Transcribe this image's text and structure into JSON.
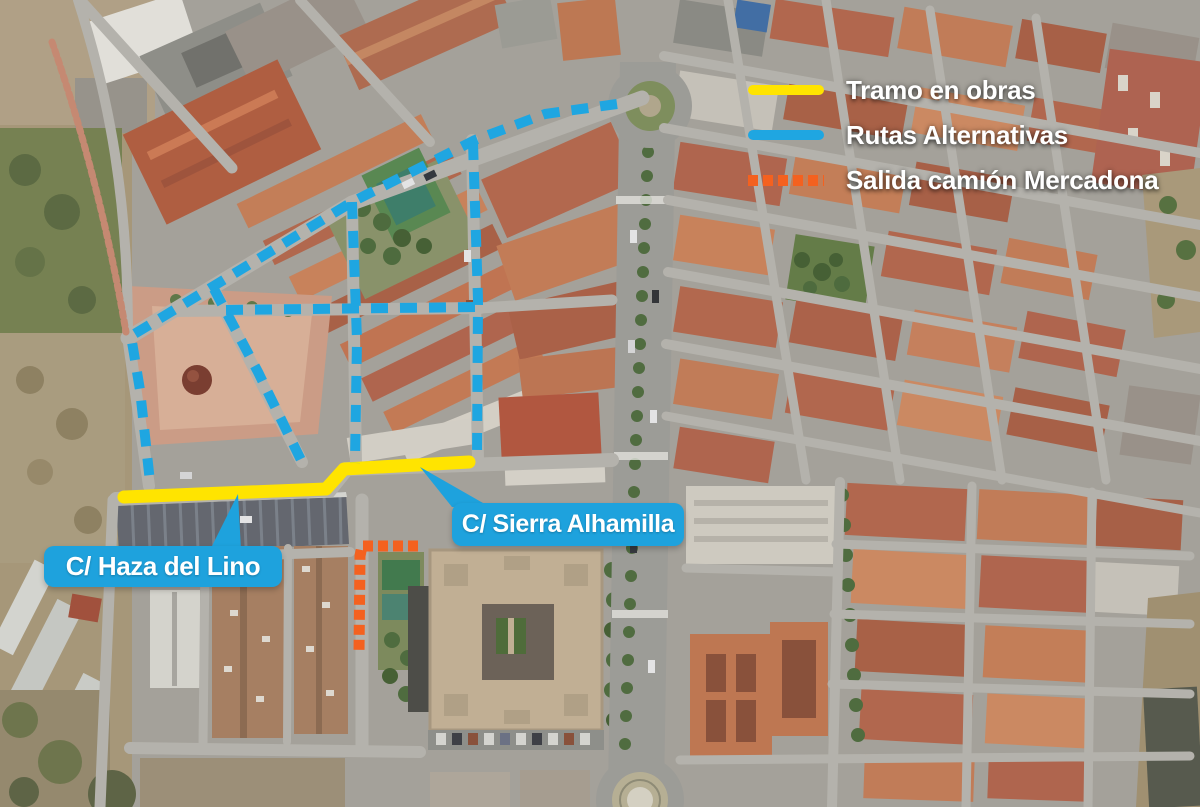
{
  "legend": {
    "items": [
      {
        "id": "tramo-en-obras",
        "label": "Tramo en obras",
        "color": "#ffe400",
        "swatch": "solid-line"
      },
      {
        "id": "rutas-alternativas",
        "label": "Rutas Alternativas",
        "color": "#1fa6e1",
        "swatch": "solid-line"
      },
      {
        "id": "salida-camion-mercadona",
        "label": "Salida camión Mercadona",
        "color": "#f4611f",
        "swatch": "dashed-line"
      }
    ]
  },
  "callouts": {
    "haza_del_lino": {
      "label": "C/ Haza del Lino",
      "color": "#1ea2dd"
    },
    "sierra_alhamilla": {
      "label": "C/ Sierra Alhamilla",
      "color": "#1ea2dd"
    }
  },
  "map_annotations": {
    "routes": [
      {
        "name": "tramo-en-obras",
        "legend": "Tramo en obras",
        "color": "#ffe400",
        "style": "solid",
        "width": 13,
        "points": [
          [
            124,
            497
          ],
          [
            326,
            489
          ],
          [
            344,
            469
          ],
          [
            469,
            462
          ]
        ]
      },
      {
        "name": "ruta-alternativa-principal",
        "legend": "Rutas Alternativas",
        "color": "#1fa6e1",
        "style": "dashed",
        "width": 10,
        "points": [
          [
            617,
            104
          ],
          [
            545,
            114
          ],
          [
            475,
            140
          ],
          [
            352,
            202
          ],
          [
            212,
            287
          ],
          [
            131,
            336
          ],
          [
            140,
            390
          ],
          [
            150,
            482
          ]
        ]
      },
      {
        "name": "ruta-alternativa-calle-oeste",
        "legend": "Rutas Alternativas",
        "color": "#1fa6e1",
        "style": "dashed",
        "width": 10,
        "points": [
          [
            352,
            202
          ],
          [
            357,
            340
          ],
          [
            355,
            463
          ]
        ]
      },
      {
        "name": "ruta-alternativa-calle-este",
        "legend": "Rutas Alternativas",
        "color": "#1fa6e1",
        "style": "dashed",
        "width": 10,
        "points": [
          [
            473,
            143
          ],
          [
            478,
            300
          ],
          [
            477,
            458
          ]
        ]
      },
      {
        "name": "ruta-alternativa-diagonal-sur",
        "legend": "Rutas Alternativas",
        "color": "#1fa6e1",
        "style": "dashed",
        "width": 10,
        "points": [
          [
            214,
            289
          ],
          [
            258,
            372
          ],
          [
            301,
            460
          ]
        ]
      },
      {
        "name": "ruta-alternativa-transversal",
        "legend": "Rutas Alternativas",
        "color": "#1fa6e1",
        "style": "dashed",
        "width": 10,
        "points": [
          [
            226,
            310
          ],
          [
            477,
            307
          ]
        ]
      },
      {
        "name": "salida-camion-mercadona",
        "legend": "Salida camión Mercadona",
        "color": "#f4611f",
        "style": "square-dotted",
        "width": 11,
        "points": [
          [
            418,
            546
          ],
          [
            362,
            546
          ],
          [
            360,
            556
          ],
          [
            359,
            653
          ]
        ]
      }
    ]
  }
}
